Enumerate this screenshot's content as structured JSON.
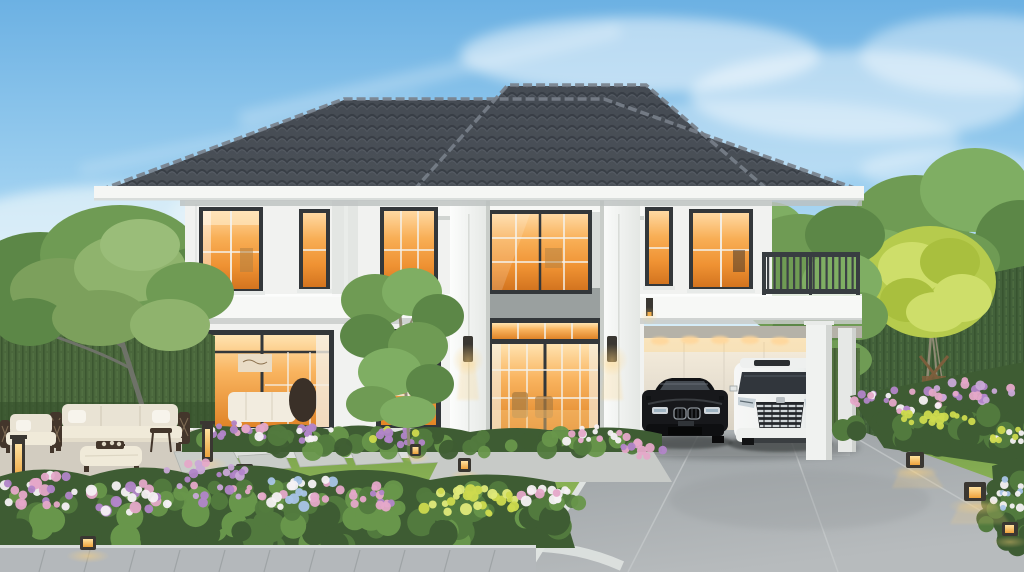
{
  "scene": {
    "setting": "residential-front-yard-at-dusk",
    "house": {
      "stories": 2,
      "style": "contemporary-luxury",
      "roof": "dark-gray-tile-hip-roof",
      "facade": "white-with-pilasters",
      "features": [
        "central-double-height-portico",
        "glass-entry-doors",
        "warm-interior-lighting",
        "carport",
        "roof-terrace-railing",
        "wall-sconces"
      ]
    },
    "vehicles": [
      {
        "name": "black-luxury-sedan"
      },
      {
        "name": "white-luxury-minivan"
      }
    ],
    "garden": [
      "manicured-lawn",
      "flower-borders",
      "stepping-stones",
      "outdoor-lounge-set",
      "bollard-lights",
      "privacy-hedge",
      "ornamental-trees",
      "paved-driveway",
      "front-walkway"
    ],
    "palette": {
      "skyTop": "#6cb1e3",
      "skyMid": "#9ed0f0",
      "skyLow": "#d9eef8",
      "cloud": "#ffffff",
      "roofBase": "#4b5158",
      "roofBase2": "#454b53",
      "roofLight": "#78808a",
      "roofArc": "#343a42",
      "roofArcHi": "#6b727c",
      "fascia": "#f5f6f4",
      "fasciaShadow": "#bcc0bf",
      "wall": "#f1f2f0",
      "wallShade": "#e3e6e3",
      "cornice": "#f7f8f6",
      "corniceShadow": "#c9cdca",
      "bandGray": "#9aa09f",
      "surround": "#d9dcda",
      "surroundLow": "#e7e9e6",
      "plinth": "#dde0dd",
      "colHi": "#fcfdfc",
      "colLo": "#e4e7e4",
      "colEdge": "#c9cdc9",
      "frame": "#33373a",
      "mullion": "#f4f2ec",
      "glassTop": "#ffd9a2",
      "glassMid": "#f8ae55",
      "glassDeep": "#ef9233",
      "glassLow": "#d3741f",
      "glassBrightTop": "#ffe3b0",
      "glassBrightMid": "#f9b45f",
      "glassBrightLow": "#e08427",
      "glowPale": "#ffe9c4",
      "curtain": "#f5efe4",
      "interiorWood": "#b07f41",
      "interiorDark": "#3a3028",
      "artBeige": "#e9dcc6",
      "sofaInWin": "#f2ecdf",
      "carportTop": "#f7eedd",
      "carportLow": "#cfc9bd",
      "soffit": "#b5b2a8",
      "colFace": "#f0f2f0",
      "colShade": "#d3d6d3",
      "railing": "#383d41",
      "baluster": "#3c4145",
      "grassTop": "#6e9546",
      "grassMid": "#88b054",
      "grassLow": "#a3ca64",
      "hedge": "#4a673c",
      "hedgeDark": "#36502c",
      "hedgeRight": "#42603a",
      "hedgeCarport": "#516f3e",
      "hedgeLine": "#314a28",
      "hedgeLite": "#5d7f49",
      "shrub": "#527a3e",
      "shrubDark": "#3e5c33",
      "shrubLight": "#68964b",
      "tree": "#6f9b54",
      "treeDark": "#5c8747",
      "treeLight": "#7fae63",
      "treeOlive": "#8fb36d",
      "treeOlive2": "#7ca05c",
      "treeYellow": "#b6cb4d",
      "treeYellowLt": "#cede6a",
      "treeYellowDk": "#a9bf3e",
      "trunk": "#8f8a74",
      "trunkGray": "#6e7268",
      "stake": "#7c5e3c",
      "flowerPurple": "#b285c9",
      "flowerLavender": "#c9a8d8",
      "flowerPink": "#e5a8c9",
      "flowerWhite": "#f5f1f4",
      "flowerYellow": "#cdda4e",
      "flowerYellowLight": "#e0ea7a",
      "flowerBlue": "#a9c4e8",
      "patio": "#d2ccc0",
      "patioEdge": "#bfb9ad",
      "stone": "#c9cdc9",
      "stoneEdge": "#aeb2ae",
      "pad": "#c7cac7",
      "drive": "#9aa0a3",
      "driveLight": "#b7bbbd",
      "joint": "#c6c9cb",
      "curb": "#dfe3e1",
      "walk": "#b4b8bb",
      "walkEdge": "#d9dddc",
      "walkJoint": "#989da0",
      "carBody": "#17181b",
      "carHi": "#51565c",
      "carGlass": "#454b52",
      "chrome": "#cfd5d8",
      "grilleDark": "#0a0b0c",
      "vanBody": "#f6f7f6",
      "vanShade": "#d3d6d5",
      "vanGlass": "#31363c",
      "vanGrille": "#23262a",
      "lampDark": "#3a3732",
      "lampGlowA": "#ffe2a0",
      "lampGlowB": "#eda23c",
      "glowWarm": "#ffd27a",
      "shadowC": "#2a2d2e",
      "sofaBack": "#e9e3d4",
      "sofaSeat": "#f0ead9",
      "pillow": "#f7f4ec",
      "sofaFrame": "#43362b"
    },
    "flower_clusters": [
      {
        "layer": "bed",
        "cx": 420,
        "cy": 443,
        "rx": 238,
        "ry": 10,
        "n": 48,
        "rmin": 6,
        "rmax": 11,
        "colors": [
          "shrub",
          "shrubDark",
          "shrubLight"
        ],
        "op": 0.95
      },
      {
        "layer": "fg",
        "cx": 285,
        "cy": 523,
        "rx": 305,
        "ry": 26,
        "n": 75,
        "rmin": 9,
        "rmax": 16,
        "colors": [
          "shrubDark",
          "shrub",
          "shrubLight"
        ],
        "op": 1
      },
      {
        "layer": "fg",
        "cx": 300,
        "cy": 500,
        "rx": 295,
        "ry": 14,
        "n": 42,
        "rmin": 6,
        "rmax": 10,
        "colors": [
          "shrubLight",
          "shrub"
        ],
        "op": 0.95
      },
      {
        "layer": "right",
        "cx": 942,
        "cy": 430,
        "rx": 102,
        "ry": 17,
        "n": 42,
        "rmin": 8,
        "rmax": 13,
        "colors": [
          "shrub",
          "shrubDark"
        ],
        "op": 1
      },
      {
        "layer": "rightcorner",
        "cx": 1010,
        "cy": 512,
        "rx": 26,
        "ry": 36,
        "n": 20,
        "rmin": 7,
        "rmax": 12,
        "colors": [
          "shrubDark",
          "shrub"
        ],
        "op": 1
      },
      {
        "layer": "bed",
        "cx": 235,
        "cy": 432,
        "rx": 38,
        "ry": 9,
        "n": 18,
        "rmin": 2.5,
        "rmax": 5,
        "colors": [
          "flowerPink",
          "flowerPurple",
          "flowerWhite"
        ],
        "op": 0.95
      },
      {
        "layer": "bed",
        "cx": 312,
        "cy": 435,
        "rx": 26,
        "ry": 8,
        "n": 12,
        "rmin": 2.5,
        "rmax": 4.5,
        "colors": [
          "flowerPurple",
          "flowerWhite"
        ],
        "op": 0.95
      },
      {
        "layer": "bed",
        "cx": 400,
        "cy": 436,
        "rx": 34,
        "ry": 9,
        "n": 14,
        "rmin": 2.5,
        "rmax": 5,
        "colors": [
          "flowerYellow",
          "flowerPurple"
        ],
        "op": 0.95
      },
      {
        "layer": "bed",
        "cx": 597,
        "cy": 436,
        "rx": 36,
        "ry": 10,
        "n": 16,
        "rmin": 2.5,
        "rmax": 5,
        "colors": [
          "flowerPink",
          "flowerWhite"
        ],
        "op": 0.95
      },
      {
        "layer": "bed",
        "cx": 643,
        "cy": 450,
        "rx": 22,
        "ry": 9,
        "n": 10,
        "rmin": 2.5,
        "rmax": 5,
        "colors": [
          "flowerPink",
          "flowerPurple"
        ],
        "op": 0.95
      },
      {
        "layer": "bed",
        "cx": 150,
        "cy": 424,
        "rx": 26,
        "ry": 7,
        "n": 10,
        "rmin": 2.5,
        "rmax": 4.5,
        "colors": [
          "flowerPink",
          "flowerWhite"
        ],
        "op": 0.9
      },
      {
        "layer": "fg",
        "cx": 45,
        "cy": 492,
        "rx": 48,
        "ry": 20,
        "n": 26,
        "rmin": 3,
        "rmax": 6,
        "colors": [
          "flowerPurple",
          "flowerPink",
          "flowerWhite"
        ],
        "op": 0.95
      },
      {
        "layer": "fg",
        "cx": 130,
        "cy": 498,
        "rx": 42,
        "ry": 16,
        "n": 22,
        "rmin": 3,
        "rmax": 6,
        "colors": [
          "flowerPink",
          "flowerWhite",
          "flowerPurple"
        ],
        "op": 0.95
      },
      {
        "layer": "fg",
        "cx": 205,
        "cy": 482,
        "rx": 48,
        "ry": 22,
        "n": 26,
        "rmin": 2.5,
        "rmax": 5,
        "colors": [
          "flowerPurple",
          "flowerLavender",
          "flowerPink"
        ],
        "op": 0.95
      },
      {
        "layer": "fg",
        "cx": 298,
        "cy": 492,
        "rx": 48,
        "ry": 16,
        "n": 26,
        "rmin": 3,
        "rmax": 5.5,
        "colors": [
          "flowerWhite",
          "flowerPink",
          "flowerBlue"
        ],
        "op": 0.95
      },
      {
        "layer": "fg",
        "cx": 372,
        "cy": 497,
        "rx": 30,
        "ry": 12,
        "n": 14,
        "rmin": 2.5,
        "rmax": 5,
        "colors": [
          "flowerPink",
          "flowerPurple"
        ],
        "op": 0.95
      },
      {
        "layer": "fg",
        "cx": 470,
        "cy": 502,
        "rx": 52,
        "ry": 15,
        "n": 30,
        "rmin": 3,
        "rmax": 6,
        "colors": [
          "flowerYellow",
          "flowerYellowLight"
        ],
        "op": 0.95
      },
      {
        "layer": "fg",
        "cx": 548,
        "cy": 494,
        "rx": 28,
        "ry": 13,
        "n": 14,
        "rmin": 3,
        "rmax": 5.5,
        "colors": [
          "flowerPink",
          "flowerWhite"
        ],
        "op": 0.95
      },
      {
        "layer": "right",
        "cx": 900,
        "cy": 400,
        "rx": 46,
        "ry": 12,
        "n": 24,
        "rmin": 2.5,
        "rmax": 5,
        "colors": [
          "flowerPurple",
          "flowerPink",
          "flowerWhite"
        ],
        "op": 0.95
      },
      {
        "layer": "right",
        "cx": 972,
        "cy": 391,
        "rx": 42,
        "ry": 11,
        "n": 22,
        "rmin": 2.5,
        "rmax": 5,
        "colors": [
          "flowerPink",
          "flowerPurple",
          "flowerLavender"
        ],
        "op": 0.95
      },
      {
        "layer": "right",
        "cx": 930,
        "cy": 419,
        "rx": 44,
        "ry": 9,
        "n": 18,
        "rmin": 2.5,
        "rmax": 4.5,
        "colors": [
          "flowerYellow"
        ],
        "op": 0.95
      },
      {
        "layer": "right",
        "cx": 1002,
        "cy": 436,
        "rx": 24,
        "ry": 9,
        "n": 12,
        "rmin": 2.5,
        "rmax": 4.5,
        "colors": [
          "flowerYellow",
          "flowerWhite"
        ],
        "op": 0.95
      },
      {
        "layer": "rightcorner",
        "cx": 1010,
        "cy": 494,
        "rx": 20,
        "ry": 16,
        "n": 14,
        "rmin": 2.5,
        "rmax": 4.5,
        "colors": [
          "flowerBlue",
          "flowerWhite"
        ],
        "op": 0.95
      }
    ]
  }
}
